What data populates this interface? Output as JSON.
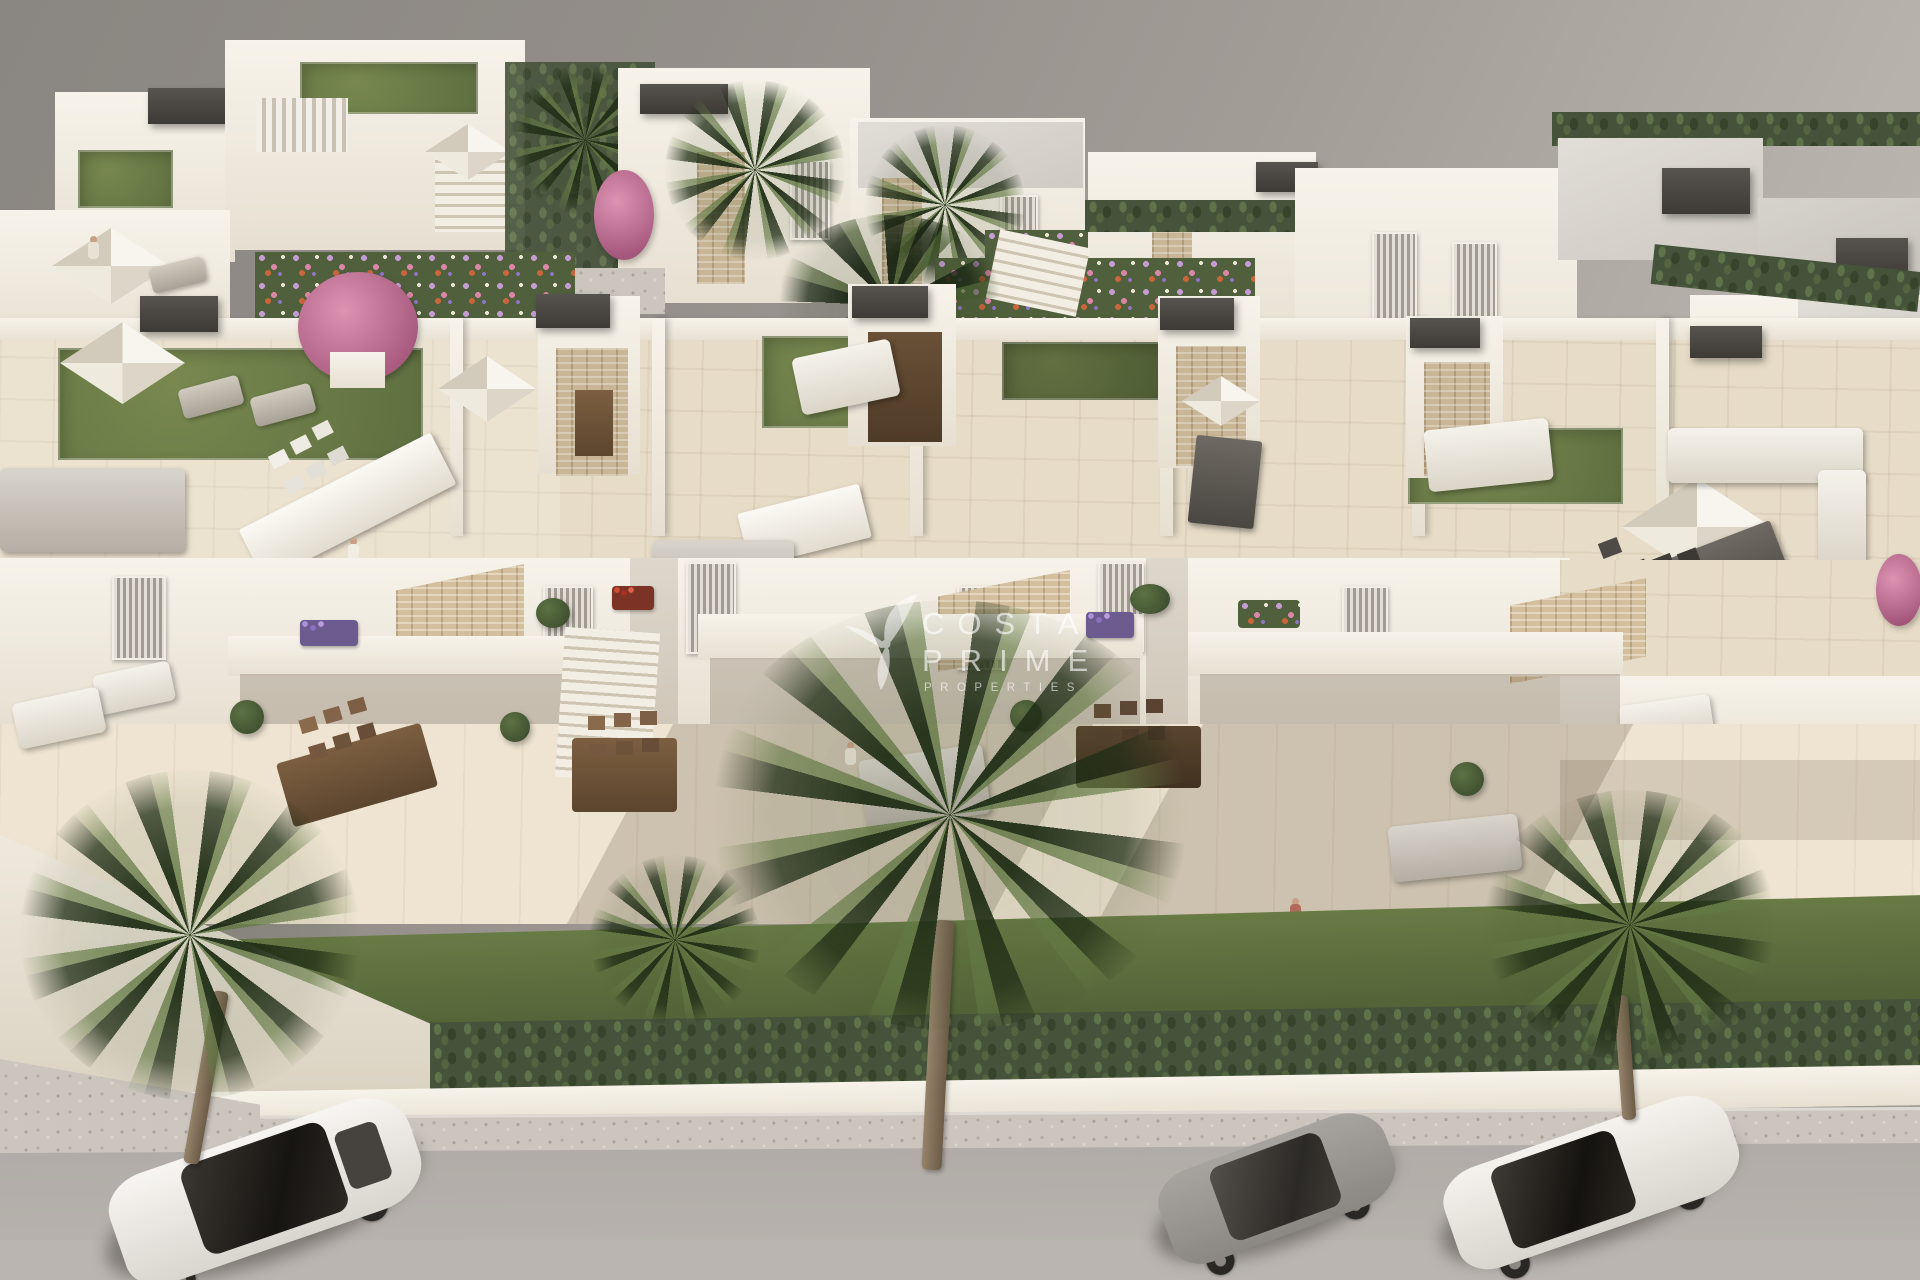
{
  "scene": {
    "description": "Aerial 3D architectural render of a modern white Mediterranean residential development: rooftop terraces with artificial grass, parasols and lounge furniture, stone-clad accents, private garden terraces, palm trees, a clipped hedge line and a street with three parked cars.",
    "cars": [
      {
        "name": "white-suv",
        "body_color": "#f3f0ea",
        "glass_color": "#23201c"
      },
      {
        "name": "gray-sports-coupe",
        "body_color": "#9c9894",
        "glass_color": "#3a3733"
      },
      {
        "name": "white-sedan",
        "body_color": "#f0ede7",
        "glass_color": "#25221d"
      }
    ]
  },
  "watermark": {
    "icon": "hummingbird-leaf-logo-icon",
    "line1": "COSTA",
    "line2": "PRIME",
    "line3": "PROPERTIES",
    "color": "#ffffff",
    "opacity": 0.62
  },
  "palette": {
    "sky_gray_dark": "#8a8681",
    "sky_gray_light": "#c7c1bb",
    "building_white": "#f4efe6",
    "building_shadow": "#d8cec0",
    "terrace_tile": "#e7dcc7",
    "stone_cladding": "#c9b696",
    "roof_gray": "#d6d2cc",
    "roof_cap_dark": "#48443f",
    "turf_green": "#6d7e49",
    "lawn_green": "#57693d",
    "hedge_green": "#45533a",
    "wood_brown": "#6f5339",
    "road_gray": "#b5b0ab",
    "sidewalk_gray": "#cbc5be"
  }
}
